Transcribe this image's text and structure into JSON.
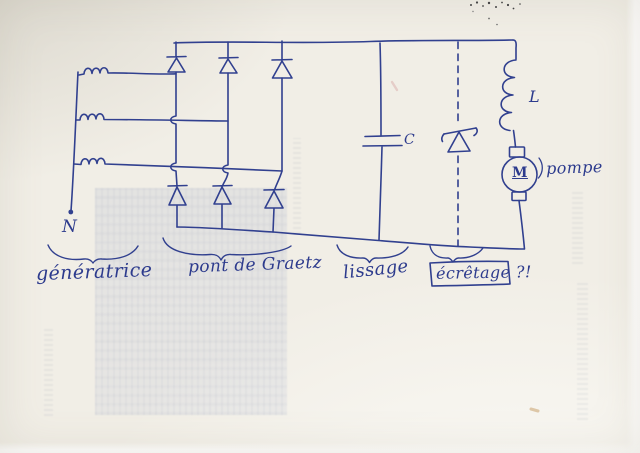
{
  "colors": {
    "ink": "#31408f",
    "paper": "#f1eee6"
  },
  "diagram": {
    "generator": {
      "neutral_label": "N",
      "caption": "génératrice",
      "phase_count": 3
    },
    "bridge": {
      "caption": "pont de Graetz",
      "diode_count": 6
    },
    "smoothing": {
      "caption": "lissage",
      "capacitor_label": "C"
    },
    "clipping": {
      "caption": "écrêtage ?!"
    },
    "load": {
      "inductor_label": "L",
      "motor_label": "M",
      "pump_label": "pompe"
    }
  }
}
